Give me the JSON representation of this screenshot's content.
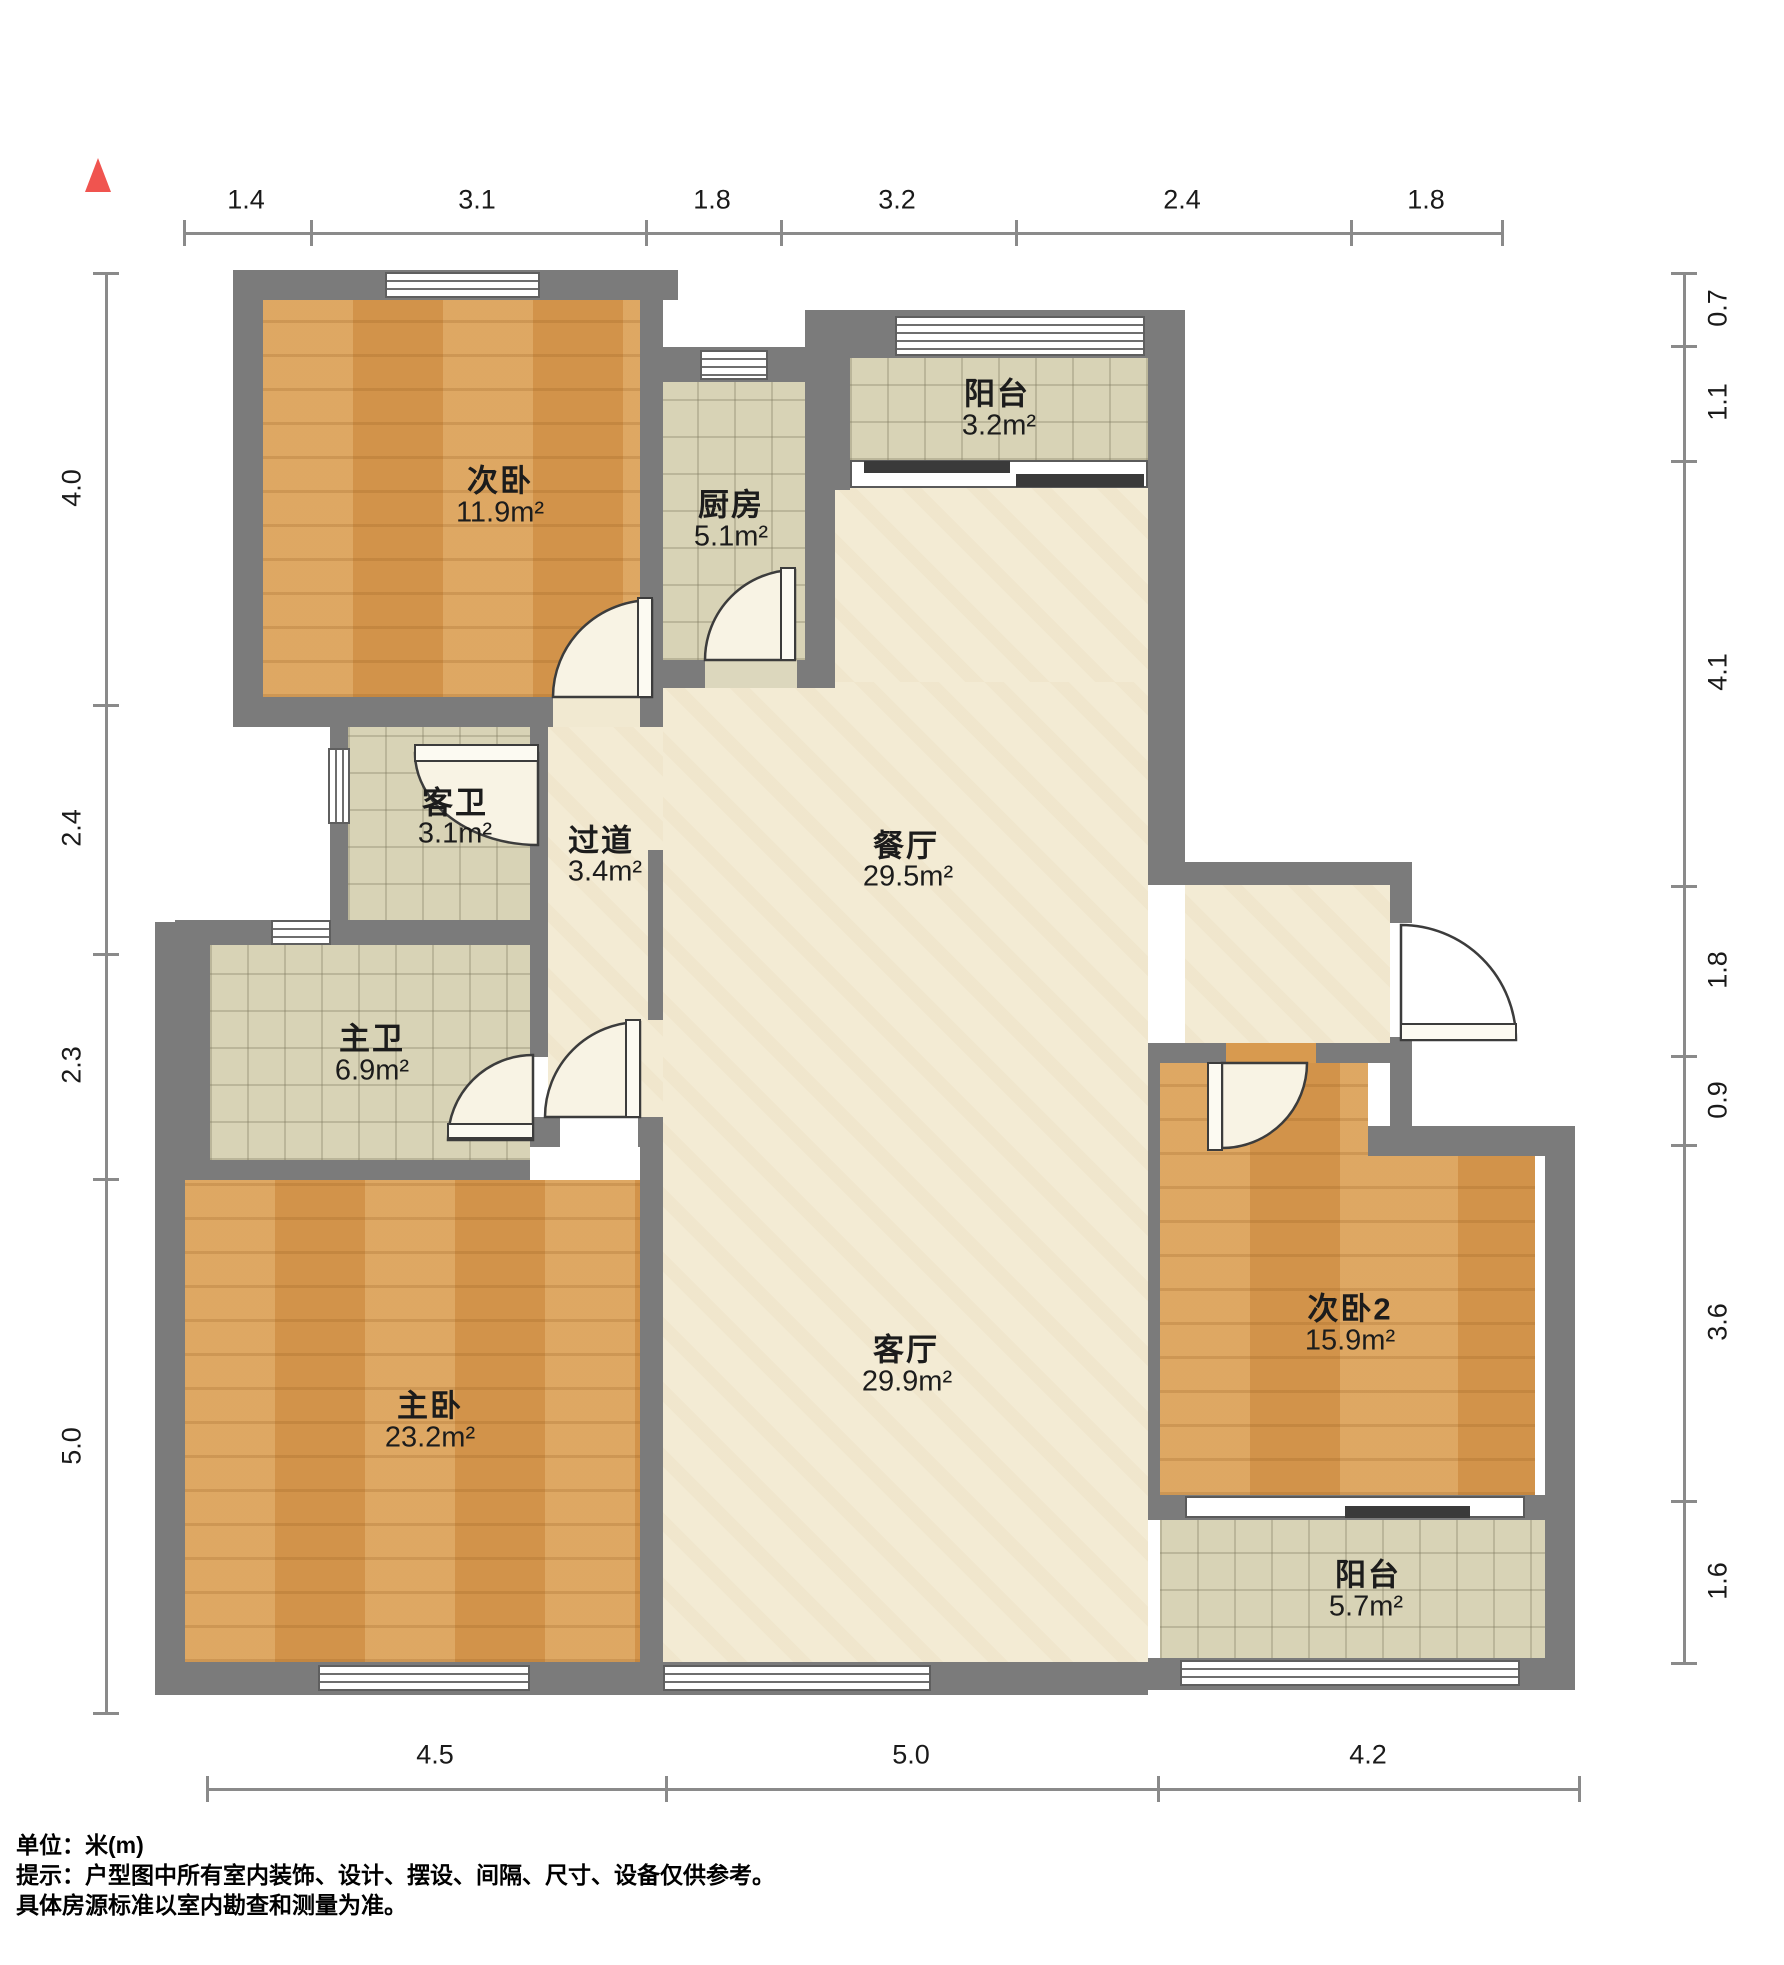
{
  "plan": {
    "type": "apartment-floor-plan",
    "north_indicator": "north-arrow"
  },
  "rooms": {
    "bedroom2": {
      "name": "次卧",
      "area": "11.9m²"
    },
    "kitchen": {
      "name": "厨房",
      "area": "5.1m²"
    },
    "balcony_north": {
      "name": "阳台",
      "area": "3.2m²"
    },
    "guest_bath": {
      "name": "客卫",
      "area": "3.1m²"
    },
    "hallway": {
      "name": "过道",
      "area": "3.4m²"
    },
    "dining": {
      "name": "餐厅",
      "area": "29.5m²"
    },
    "master_bath": {
      "name": "主卫",
      "area": "6.9m²"
    },
    "master_bedroom": {
      "name": "主卧",
      "area": "23.2m²"
    },
    "living": {
      "name": "客厅",
      "area": "29.9m²"
    },
    "bedroom3": {
      "name": "次卧2",
      "area": "15.9m²"
    },
    "balcony_south": {
      "name": "阳台",
      "area": "5.7m²"
    }
  },
  "dimensions": {
    "top": [
      "1.4",
      "3.1",
      "1.8",
      "3.2",
      "2.4",
      "1.8"
    ],
    "left": [
      "4.0",
      "2.4",
      "2.3",
      "5.0"
    ],
    "right": [
      "0.7",
      "1.1",
      "4.1",
      "1.8",
      "0.9",
      "3.6",
      "1.6"
    ],
    "bottom": [
      "4.5",
      "5.0",
      "4.2"
    ]
  },
  "footer": {
    "unit_label": "单位：米(m)",
    "note_line1": "提示：户型图中所有室内装饰、设计、摆设、间隔、尺寸、设备仅供参考。",
    "note_line2": "具体房源标准以室内勘查和测量为准。"
  },
  "colors": {
    "wall": "#7b7b7b",
    "wood_floor": "#d89a4f",
    "tile_floor": "#d8d3b6",
    "marble_floor": "#f3ebd4",
    "north_arrow": "#f0544f"
  }
}
